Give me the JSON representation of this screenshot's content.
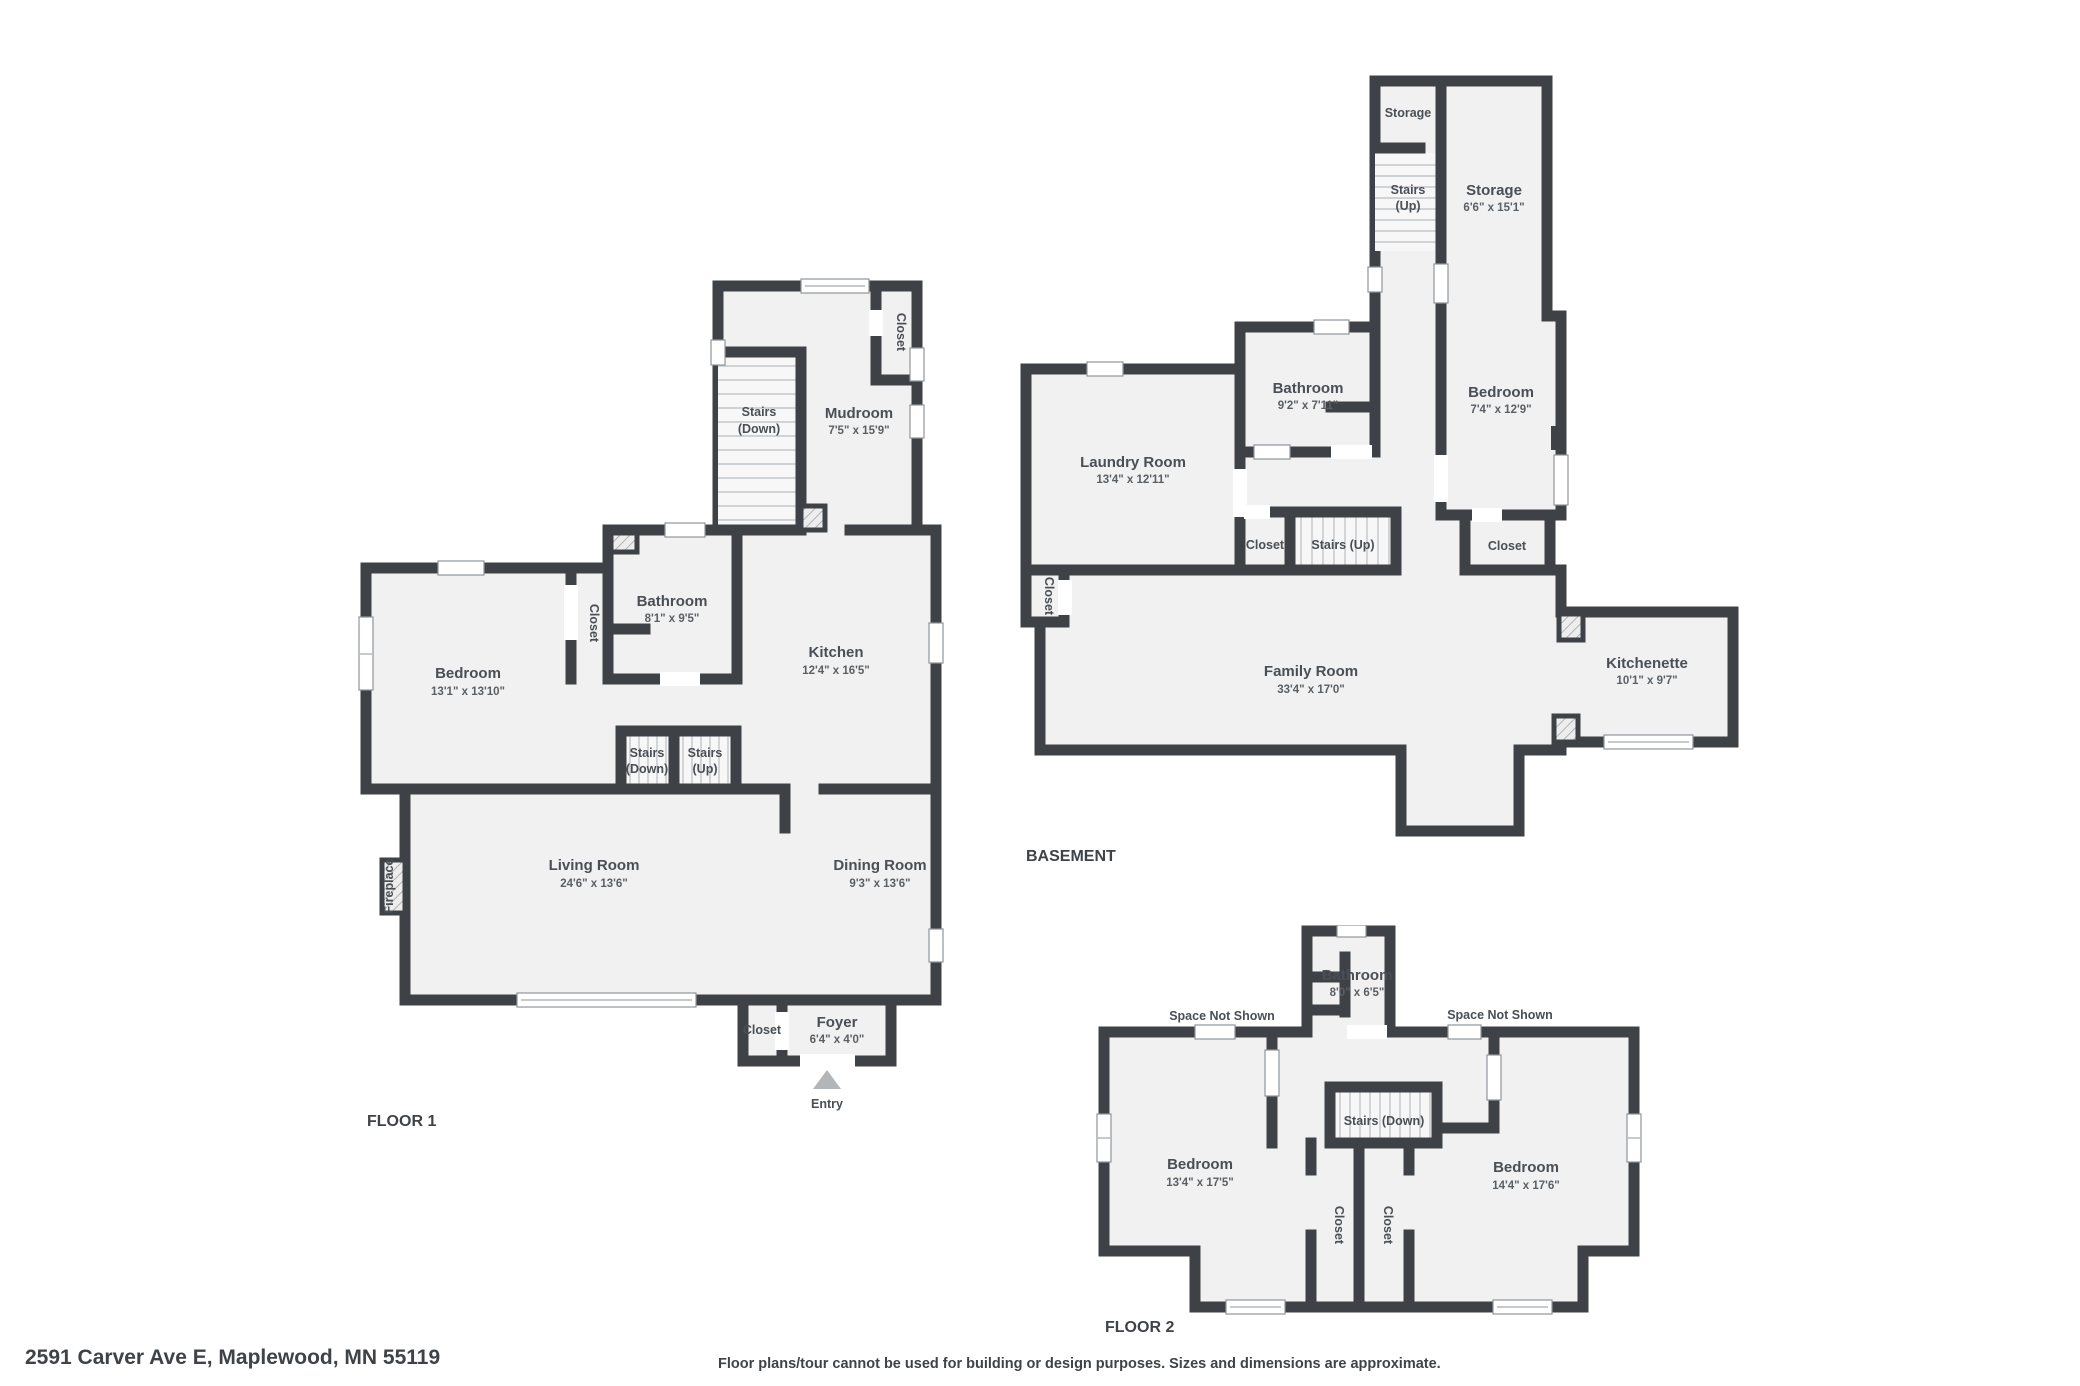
{
  "footer": {
    "address": "2591 Carver Ave E, Maplewood, MN 55119",
    "disclaimer": "Floor plans/tour cannot be used for building or design purposes. Sizes and dimensions are approximate."
  },
  "floor1": {
    "title": "FLOOR 1",
    "stairs_top": {
      "l1": "Stairs",
      "l2": "(Down)"
    },
    "mudroom": {
      "name": "Mudroom",
      "dims": "7'5\" x 15'9\""
    },
    "closet_top": "Closet",
    "bathroom": {
      "name": "Bathroom",
      "dims": "8'1\" x 9'5\""
    },
    "closet_mid": "Closet",
    "bedroom": {
      "name": "Bedroom",
      "dims": "13'1\" x 13'10\""
    },
    "kitchen": {
      "name": "Kitchen",
      "dims": "12'4\" x 16'5\""
    },
    "stairs_down": {
      "l1": "Stairs",
      "l2": "(Down)"
    },
    "stairs_up": {
      "l1": "Stairs",
      "l2": "(Up)"
    },
    "living": {
      "name": "Living Room",
      "dims": "24'6\" x 13'6\""
    },
    "dining": {
      "name": "Dining Room",
      "dims": "9'3\" x 13'6\""
    },
    "fireplace": "Fireplace",
    "closet_foyer": "Closet",
    "foyer": {
      "name": "Foyer",
      "dims": "6'4\" x 4'0\""
    },
    "entry": "Entry"
  },
  "basement": {
    "title": "BASEMENT",
    "storage_small": "Storage",
    "stairs_top": {
      "l1": "Stairs",
      "l2": "(Up)"
    },
    "storage_big": {
      "name": "Storage",
      "dims": "6'6\" x 15'1\""
    },
    "bathroom": {
      "name": "Bathroom",
      "dims": "9'2\" x 7'11\""
    },
    "bedroom": {
      "name": "Bedroom",
      "dims": "7'4\" x 12'9\""
    },
    "laundry": {
      "name": "Laundry Room",
      "dims": "13'4\" x 12'11\""
    },
    "closet_hall": "Closet",
    "stairs_mid": "Stairs (Up)",
    "closet_bedroom": "Closet",
    "closet_left": "Closet",
    "family": {
      "name": "Family Room",
      "dims": "33'4\" x 17'0\""
    },
    "kitchenette": {
      "name": "Kitchenette",
      "dims": "10'1\" x 9'7\""
    }
  },
  "floor2": {
    "title": "FLOOR 2",
    "bathroom": {
      "name": "Bathroom",
      "dims": "8'0\" x 6'5\""
    },
    "space_left": "Space Not Shown",
    "space_right": "Space Not Shown",
    "stairs_down": "Stairs (Down)",
    "bedroom_left": {
      "name": "Bedroom",
      "dims": "13'4\" x 17'5\""
    },
    "bedroom_right": {
      "name": "Bedroom",
      "dims": "14'4\" x 17'6\""
    },
    "closet_a": "Closet",
    "closet_b": "Closet"
  }
}
